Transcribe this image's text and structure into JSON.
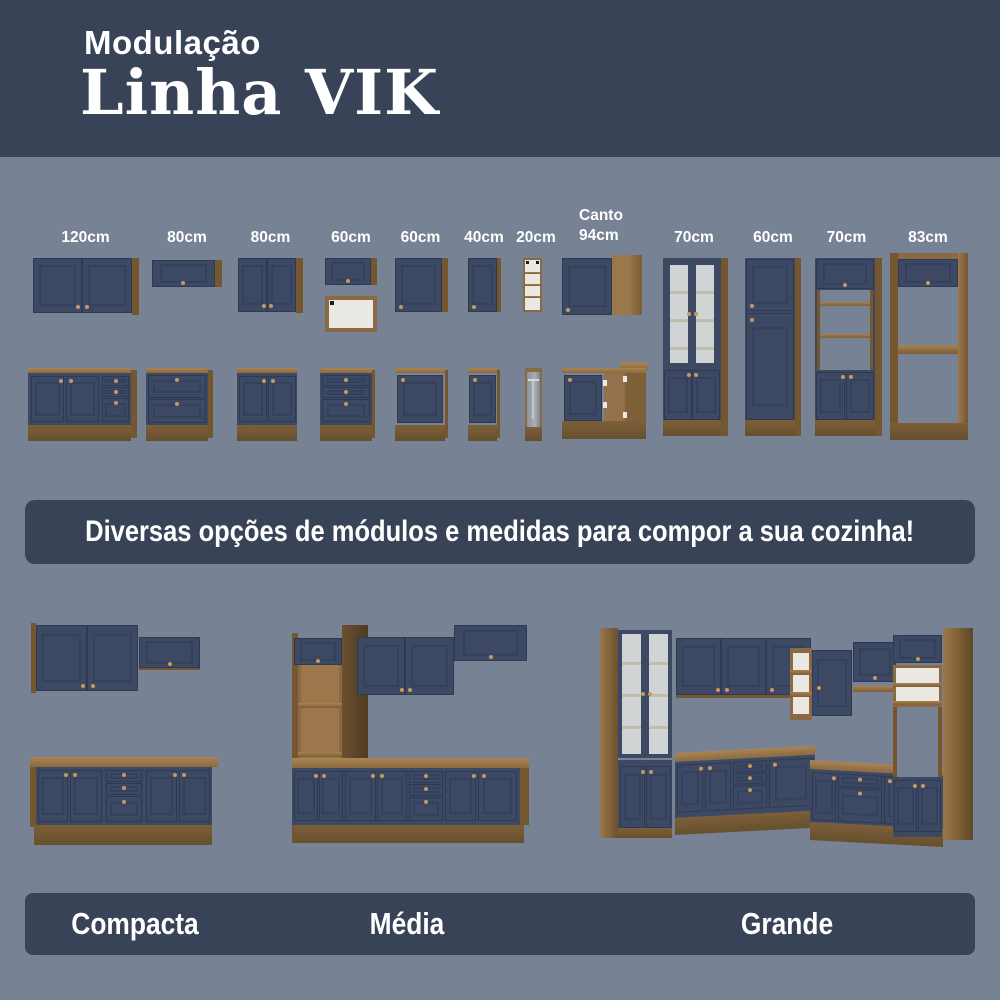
{
  "header": {
    "kicker": "Modulação",
    "title": "Linha VIK"
  },
  "modules": {
    "labels": [
      "120cm",
      "80cm",
      "80cm",
      "60cm",
      "60cm",
      "40cm",
      "20cm",
      "Canto\n94cm",
      "70cm",
      "60cm",
      "70cm",
      "83cm"
    ]
  },
  "banner": {
    "text": "Diversas opções de módulos e medidas para compor a sua cozinha!"
  },
  "layouts": [
    {
      "label": "Compacta"
    },
    {
      "label": "Média"
    },
    {
      "label": "Grande"
    }
  ],
  "colors": {
    "background": "#778294",
    "panel_navy": "#394357",
    "cabinet_navy": "#3d4963",
    "wood": "#8a6a42",
    "text": "#ffffff",
    "knob_brass": "#c49a5e"
  }
}
